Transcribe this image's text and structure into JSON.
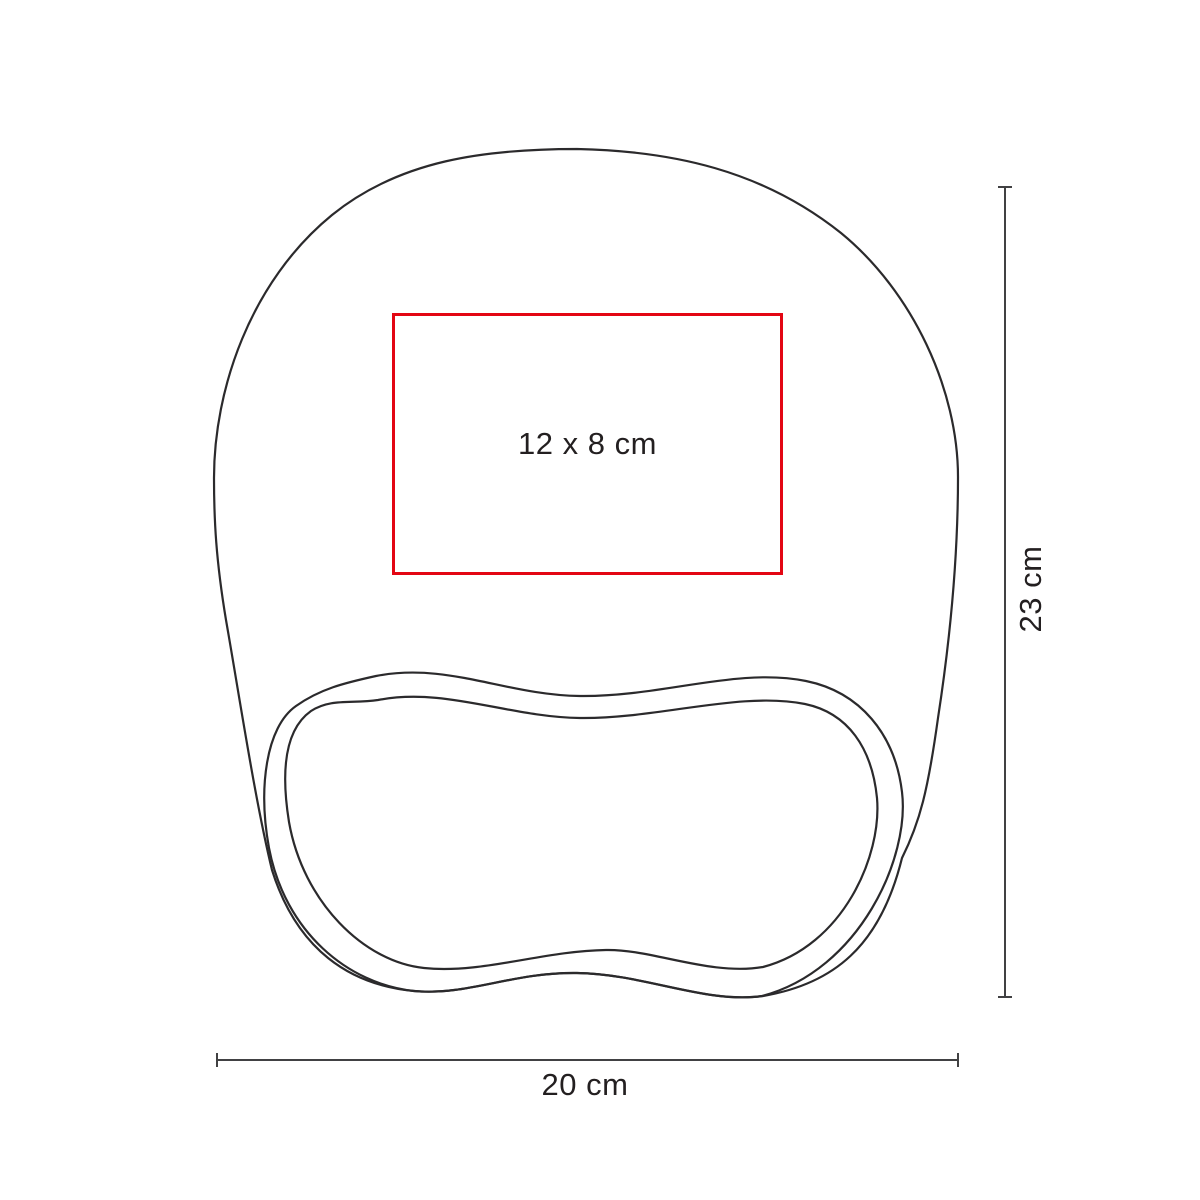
{
  "diagram": {
    "title": "mousepad-with-wrist-rest-print-area-diagram",
    "print_area": {
      "label": "12 x 8 cm",
      "border_color": "#e30613"
    },
    "dimensions": {
      "height": {
        "label": "23 cm"
      },
      "width": {
        "label": "20 cm"
      }
    },
    "colors": {
      "outline": "#2b2a2c",
      "dimension_line": "#414143",
      "text": "#231f20",
      "background": "#ffffff"
    }
  }
}
